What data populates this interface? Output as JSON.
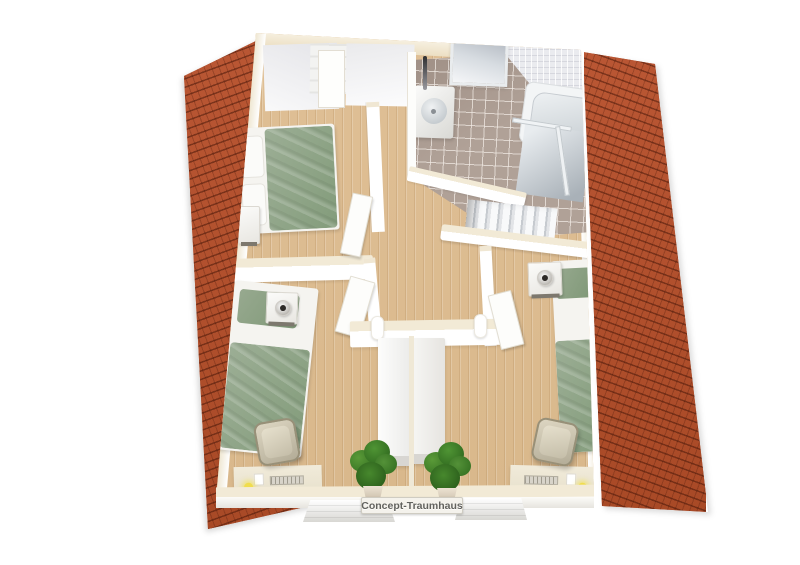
{
  "scene": {
    "type": "3D floor plan rendering, attic storey, top view",
    "background": "#ffffff"
  },
  "watermark": {
    "text": "Concept-Traumhaus"
  },
  "palette": {
    "roof_tile": "#b2512e",
    "roof_tile_shadow": "#7e3418",
    "roof_trim": "#ffffff",
    "wood_floor": "#ddbd92",
    "wall_white": "#ffffff",
    "wall_top_cream": "#f2ead6",
    "bathroom_tile": "#b0a197",
    "white_wall_tile": "#eaebef",
    "bedding_green": "#93a68c",
    "desk_cream": "#efe9da",
    "chair_tan": "#c9c2ae",
    "lamp_yellow": "#f0dd4e",
    "plant_green": "#3c7d28",
    "watermark_text": "#62625e",
    "watermark_bg": "#f4f2ec"
  },
  "rooms": [
    {
      "name": "bedroom-top-left",
      "contents": [
        "double-bed",
        "nightstand",
        "dresser",
        "sloped-ceiling",
        "door"
      ]
    },
    {
      "name": "bathroom",
      "contents": [
        "washbasin",
        "faucet",
        "bathtub",
        "shower",
        "skylight-window",
        "tiled-floor"
      ]
    },
    {
      "name": "hallway",
      "contents": [
        "staircase",
        "railing-wall",
        "open-doors"
      ]
    },
    {
      "name": "bedroom-bottom-left",
      "contents": [
        "single-bed",
        "nightstand-with-lamp",
        "desk",
        "office-chair",
        "desk-lamp"
      ]
    },
    {
      "name": "bedroom-bottom-right",
      "contents": [
        "single-bed",
        "nightstand-with-lamp",
        "desk",
        "office-chair",
        "desk-lamp"
      ]
    },
    {
      "name": "landing",
      "contents": [
        "wardrobes",
        "potted-plants",
        "window-sills"
      ]
    }
  ]
}
